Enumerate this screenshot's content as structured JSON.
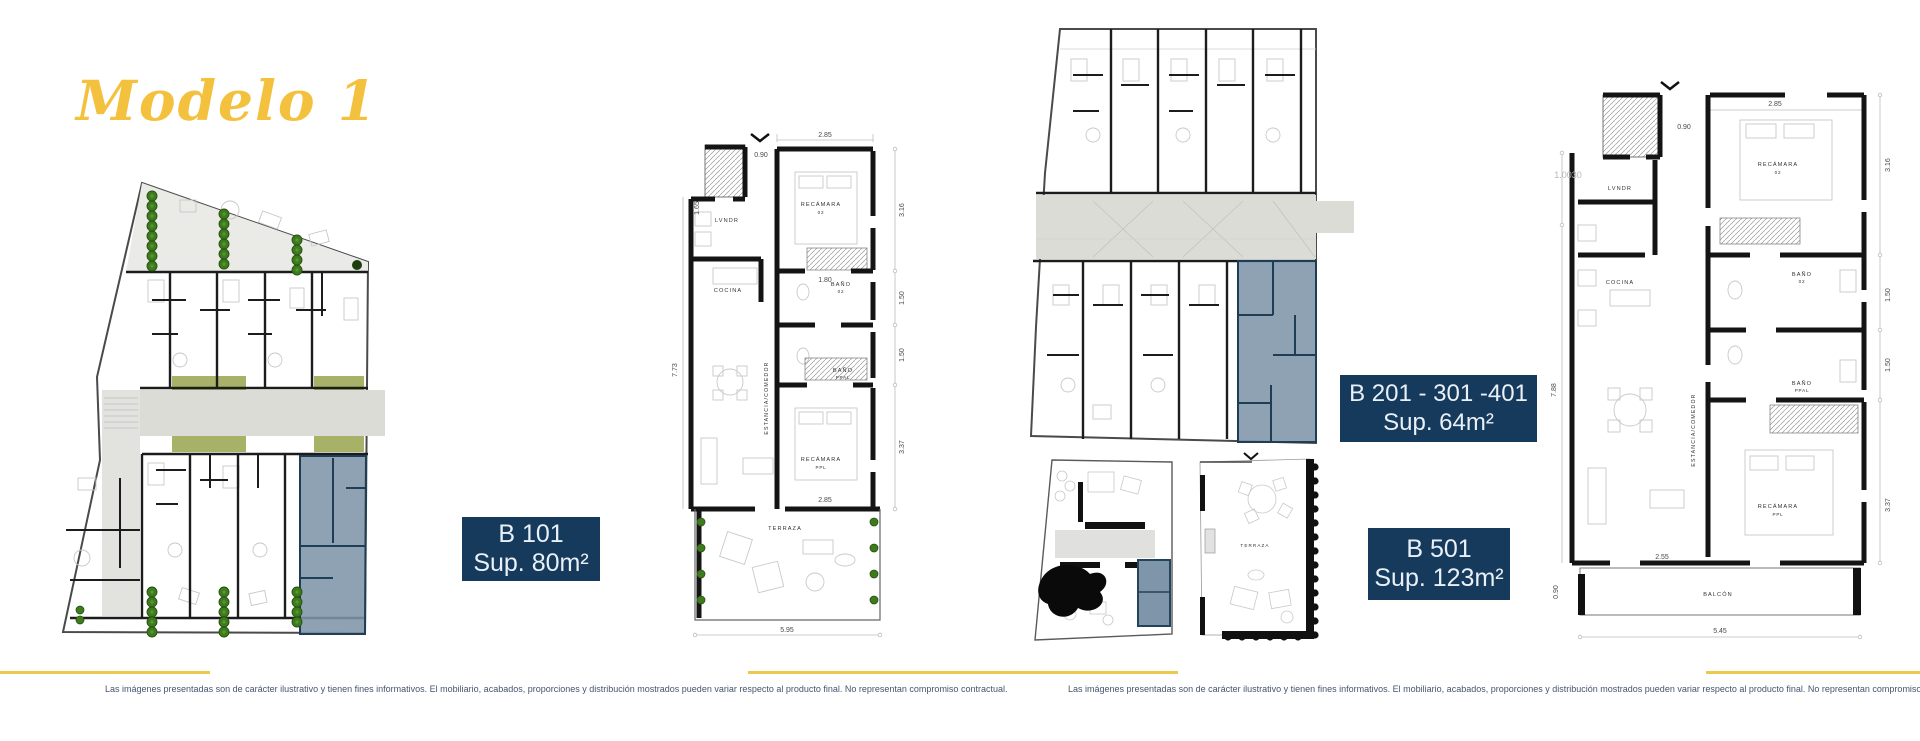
{
  "title": "Modelo 1",
  "unit_labels": {
    "b101": {
      "name": "B 101",
      "area": "Sup. 80m²"
    },
    "b201": {
      "name": "B 201 - 301 -401",
      "area": "Sup. 64m²"
    },
    "b501": {
      "name": "B 501",
      "area": "Sup. 123m²"
    }
  },
  "disclaimer": "Las imágenes presentadas son de carácter ilustrativo y tienen fines informativos. El mobiliario, acabados, proporciones y distribución mostrados pueden variar respecto al producto final. No representan compromiso contractual.",
  "plans": {
    "b101": {
      "rooms": {
        "laundry": "LVNDR",
        "kitchen": "COCINA",
        "living": "ESTANCIA/COMEDOR",
        "bedroom2": "RECÁMARA",
        "bedroom2_num": "02",
        "bath2": "BAÑO",
        "bath2_num": "02",
        "bath_main": "BAÑO",
        "bath_main_num": "PPAL",
        "bedroom_main": "RECÁMARA",
        "bedroom_main_num": "PPL",
        "terrace": "TERRAZA"
      },
      "dims": {
        "width_top": "2.85",
        "entry": "0.90",
        "right1": "3.16",
        "right2": "1.50",
        "right3": "1.50",
        "right4": "3.37",
        "inner": "1.80",
        "left_upper": "1.65",
        "left": "7.73",
        "bed_width": "2.85",
        "total_width": "5.95"
      }
    },
    "b501": {
      "rooms": {
        "laundry": "LVNDR",
        "kitchen": "COCINA",
        "living": "ESTANCIA/COMEDOR",
        "bedroom2": "RECÁMARA",
        "bedroom2_num": "02",
        "bath2": "BAÑO",
        "bath2_num": "02",
        "bath_main": "BAÑO",
        "bath_main_num": "PPAL",
        "bedroom_main": "RECÁMARA",
        "bedroom_main_num": "PPL",
        "balcony": "BALCÓN",
        "terrace": "TERRAZA"
      },
      "dims": {
        "width_top": "2.85",
        "entry": "0.90",
        "right1": "3.16",
        "right2": "1.50",
        "right3": "1.50",
        "right4": "3.37",
        "left_upper": "1.0030",
        "left": "7.88",
        "living_width": "2.55",
        "total_width": "5.45",
        "balcony_h": "0.90"
      }
    }
  },
  "colors": {
    "accent_gold": "#EAC94F",
    "navy": "#163A5C",
    "highlight_blue": "#7E95AA",
    "tree_green": "#3E7A1E",
    "olive": "#A8B168"
  }
}
